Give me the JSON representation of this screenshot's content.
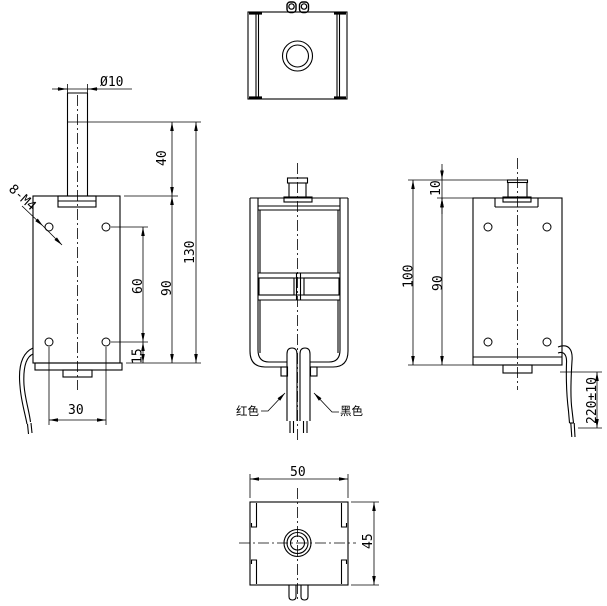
{
  "drawing": {
    "kind": "solenoid-electromagnet-orthographic-drawing",
    "background": "#ffffff",
    "line_color": "#000000"
  },
  "views": {
    "side": {
      "dims": {
        "shaft_dia": "Ø10",
        "shaft_ext": "40",
        "overall_h": "130",
        "body_h": "90",
        "hole_span_v": "60",
        "hole_off_bottom": "15",
        "hole_span_h": "30",
        "thread_callout": "8-M4"
      }
    },
    "front": {
      "wire_red": "红色",
      "wire_black": "黑色"
    },
    "right": {
      "dims": {
        "shaft_top": "10",
        "overall_h": "100",
        "body_h": "90",
        "lead_len": "220±10"
      }
    },
    "bottom": {
      "dims": {
        "width": "50",
        "depth": "45"
      }
    }
  }
}
